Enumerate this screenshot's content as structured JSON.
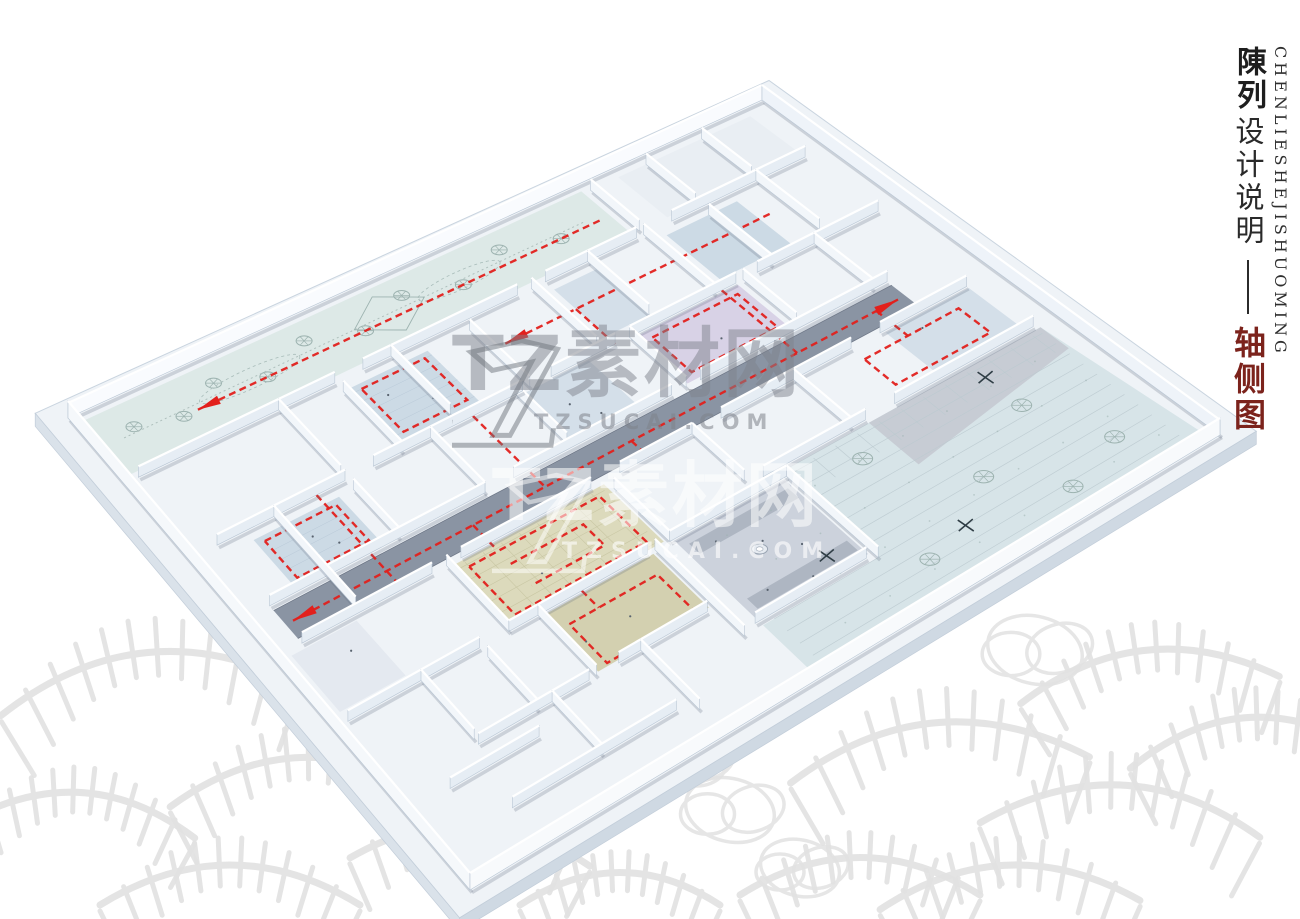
{
  "page": {
    "width": 1300,
    "height": 919,
    "background": "#ffffff"
  },
  "title_block": {
    "english_vertical": "CHENLIESHEJISHUOMING",
    "series_bold": "陳列",
    "series_regular": "设计说明",
    "subtitle_red": "轴侧图",
    "text_color": "#222222",
    "accent_color": "#7c231c"
  },
  "watermarks": {
    "primary": {
      "brand": "TZ素材网",
      "domain": "TZSUCAI.COM",
      "color": "#82878f"
    },
    "secondary": {
      "brand": "TZ素材网",
      "domain": "TZSUCAI.COM",
      "color": "#ffffff"
    }
  },
  "diagram": {
    "type": "axonometric-floor-plan",
    "colors": {
      "slab": "#eff3f7",
      "slab_side_left": "#dae2ea",
      "slab_side_right": "#cfd9e3",
      "wall_side": "#e6edf4",
      "wall_side_alt": "#f2f6fa",
      "wall_edge": "#b9c6d4",
      "wall_top": "#ffffff",
      "parapet_far": "#f9fbfe",
      "parapet_right": "#eef3f9",
      "parapet_near_left": "#f5f8fb",
      "parapet_near_bottom": "#f8fafc",
      "floor_grid_room": "#ccdae5",
      "floor_grid_room_alt": "#d4dfe9",
      "floor_khaki": "#dcdabc",
      "floor_khaki_dark": "#d3d0b0",
      "floor_lavender": "#d8d2e6",
      "floor_garden": "#dde9e7",
      "floor_courtyard": "#d7e4e8",
      "floor_corridor": "#8a94a3",
      "floor_room_gray": "#ccd2dc",
      "walkway_gray": "#c7ccd4",
      "route_red": "#e2201c",
      "plant_stroke": "#9db3b0",
      "tree_mark": "#2f3d45",
      "sketch_gray": "#e2e2e2"
    }
  }
}
